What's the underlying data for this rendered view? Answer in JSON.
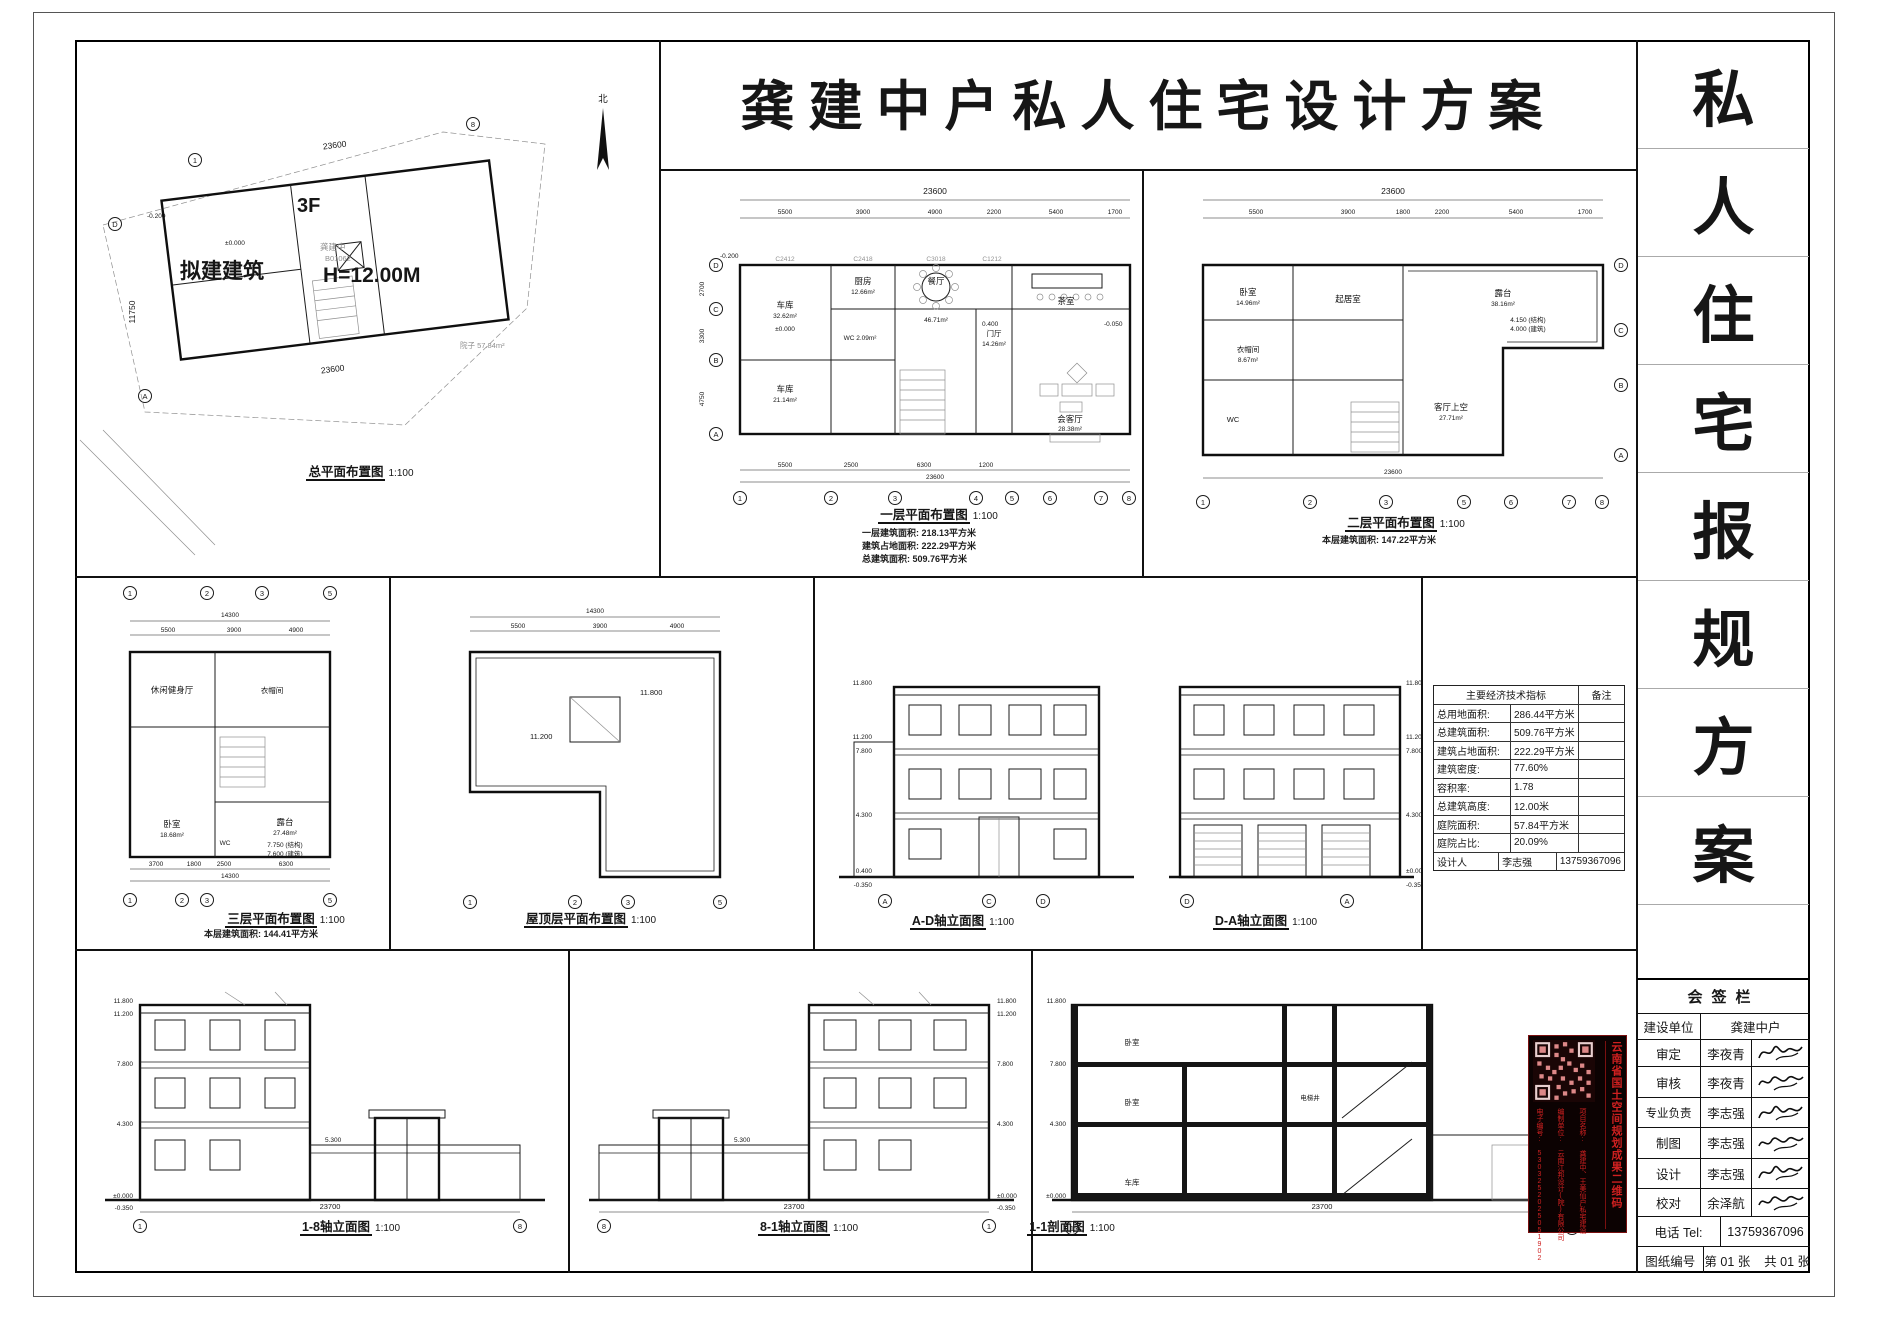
{
  "title": "龚建中户私人住宅设计方案",
  "compass": "北",
  "site": {
    "caption": "总平面布置图",
    "scale": "1:100",
    "floors": "3F",
    "building": "拟建建筑",
    "height": "H=12.00M",
    "owner": "龚建中",
    "owner_no": "B01062",
    "yard": "院子 57.84m²",
    "lv0": "±0.000",
    "lvn": "-0.200",
    "dim_top": "23600",
    "dim_bottom": "23600",
    "dim_left": "11750"
  },
  "plan1": {
    "caption": "一层平面布置图",
    "scale": "1:100",
    "notes": [
      "一层建筑面积: 218.13平方米",
      "建筑占地面积: 222.29平方米",
      "总建筑面积: 509.76平方米"
    ],
    "dim_total": "23600",
    "dim_total_b": "23600",
    "dims_top": [
      "5500",
      "3900",
      "4900",
      "2200",
      "5400",
      "1700"
    ],
    "dims_bottom": [
      "5500",
      "2500",
      "6300",
      "1200"
    ],
    "axes_b": [
      "1",
      "2",
      "3",
      "4",
      "5",
      "6",
      "7",
      "8"
    ],
    "axes_l": [
      "D",
      "C",
      "B",
      "A"
    ],
    "dims_l": [
      "2700",
      "3300",
      "4750"
    ],
    "rooms": {
      "garage1": "车库",
      "garage1a": "32.62m²",
      "kitchen": "厨房",
      "kitchena": "12.66m²",
      "dining": "餐厅",
      "dininga": "46.71m²",
      "tea": "茶室",
      "wc": "WC 2.09m²",
      "hall": "门厅",
      "halla": "14.26m²",
      "garage2": "车库",
      "garage2a": "21.14m²",
      "living": "会客厅",
      "livinga": "28.38m²"
    },
    "lv": {
      "a": "±0.000",
      "b": "0.400",
      "c": "-0.050",
      "d": "-0.200"
    },
    "codes": [
      "C2412",
      "C2418",
      "C3018",
      "C1212"
    ]
  },
  "plan2": {
    "caption": "二层平面布置图",
    "scale": "1:100",
    "note": "本层建筑面积: 147.22平方米",
    "dim_total": "23600",
    "dim_total_b": "23600",
    "dims_top": [
      "5500",
      "3900",
      "1800",
      "2200",
      "5400",
      "1700"
    ],
    "axes_b": [
      "1",
      "2",
      "3",
      "5",
      "6",
      "7",
      "8"
    ],
    "axes_r": [
      "D",
      "C",
      "B",
      "A"
    ],
    "rooms": {
      "terr": "露台",
      "terra": "38.16m²",
      "bed": "卧室",
      "beda": "14.96m²",
      "sit": "起居室",
      "cloak": "衣帽间",
      "cloaka": "8.67m²",
      "wc": "WC",
      "void": "客厅上空",
      "voida": "27.71m²"
    },
    "lv1": "4.150 (结构)",
    "lv2": "4.000 (建筑)"
  },
  "plan3": {
    "caption": "三层平面布置图",
    "scale": "1:100",
    "note": "本层建筑面积: 144.41平方米",
    "dim_total": "14300",
    "dim_total_b": "14300",
    "dims_top": [
      "5500",
      "3900",
      "4900"
    ],
    "dims_bottom": [
      "3700",
      "1800",
      "2500",
      "6300"
    ],
    "axes_b": [
      "1",
      "2",
      "3",
      "5"
    ],
    "rooms": {
      "gym": "休闲健身厅",
      "cloak": "衣帽间",
      "bed": "卧室",
      "beda": "18.68m²",
      "wc": "WC",
      "terr": "露台",
      "terra": "27.48m²"
    },
    "lv1": "7.750 (结构)",
    "lv2": "7.600 (建筑)"
  },
  "roof": {
    "caption": "屋顶层平面布置图",
    "scale": "1:100",
    "dim_total": "14300",
    "dims_top": [
      "5500",
      "3900",
      "4900"
    ],
    "axes": [
      "1",
      "2",
      "3",
      "5"
    ],
    "lv1": "11.200",
    "lv2": "11.800"
  },
  "elev_ad": {
    "caption": "A-D轴立面图",
    "scale": "1:100",
    "axes": [
      "A",
      "C",
      "D"
    ],
    "levels": [
      "11.800",
      "11.200",
      "7.800",
      "4.300",
      "0.400",
      "-0.350"
    ]
  },
  "elev_da": {
    "caption": "D-A轴立面图",
    "scale": "1:100",
    "axes": [
      "D",
      "A"
    ],
    "levels": [
      "11.800",
      "11.200",
      "7.800",
      "4.300",
      "±0.000",
      "-0.350"
    ]
  },
  "elev_18": {
    "caption": "1-8轴立面图",
    "scale": "1:100",
    "axes": [
      "1",
      "8"
    ],
    "levels": [
      "11.800",
      "11.200",
      "7.800",
      "4.300",
      "±0.000",
      "-0.350"
    ],
    "wall_lv": "5.300",
    "dim_b": "23700"
  },
  "elev_81": {
    "caption": "8-1轴立面图",
    "scale": "1:100",
    "axes": [
      "8",
      "1"
    ],
    "levels": [
      "11.800",
      "11.200",
      "7.800",
      "4.300",
      "±0.000",
      "-0.350"
    ],
    "wall_lv": "5.300",
    "dim_b": "23700"
  },
  "sect_11": {
    "caption": "1-1剖面图",
    "scale": "1:100",
    "axes": [
      "1",
      "1"
    ],
    "levels": [
      "11.800",
      "7.800",
      "4.300",
      "±0.000"
    ],
    "dim_b": "23700",
    "rooms": {
      "bed1": "卧室",
      "bed2": "卧室",
      "garage": "车库",
      "lift": "电梯井"
    }
  },
  "econ": {
    "header": "主要经济技术指标",
    "remark": "备注",
    "rows": [
      [
        "总用地面积:",
        "286.44平方米"
      ],
      [
        "总建筑面积:",
        "509.76平方米"
      ],
      [
        "建筑占地面积:",
        "222.29平方米"
      ],
      [
        "建筑密度:",
        "77.60%"
      ],
      [
        "容积率:",
        "1.78"
      ],
      [
        "总建筑高度:",
        "12.00米"
      ],
      [
        "庭院面积:",
        "57.84平方米"
      ],
      [
        "庭院占比:",
        "20.09%"
      ],
      [
        "设计人",
        "李志强"
      ]
    ],
    "phone": "13759367096"
  },
  "qr": {
    "title": "云南省国土空间规划成果二维码",
    "project": "项目名称: 龚建中、王美仙户私宅建设",
    "unit": "编制单位: 云南江邦设计(院)有限公司",
    "serial": "电子编号: 5303252025051902"
  },
  "strip": [
    "私",
    "人",
    "住",
    "宅",
    "报",
    "规",
    "方",
    "案"
  ],
  "sign": {
    "title": "会签栏",
    "rows": [
      {
        "label": "建设单位",
        "value": "龚建中户"
      },
      {
        "label": "审定",
        "value": "李夜青"
      },
      {
        "label": "审核",
        "value": "李夜青"
      },
      {
        "label": "专业负责",
        "value": "李志强"
      },
      {
        "label": "制图",
        "value": "李志强"
      },
      {
        "label": "设计",
        "value": "李志强"
      },
      {
        "label": "校对",
        "value": "余泽航"
      },
      {
        "label": "电话 Tel:",
        "value": "13759367096"
      },
      {
        "label": "图纸编号",
        "value": "第 01 张    共 01 张"
      }
    ]
  }
}
